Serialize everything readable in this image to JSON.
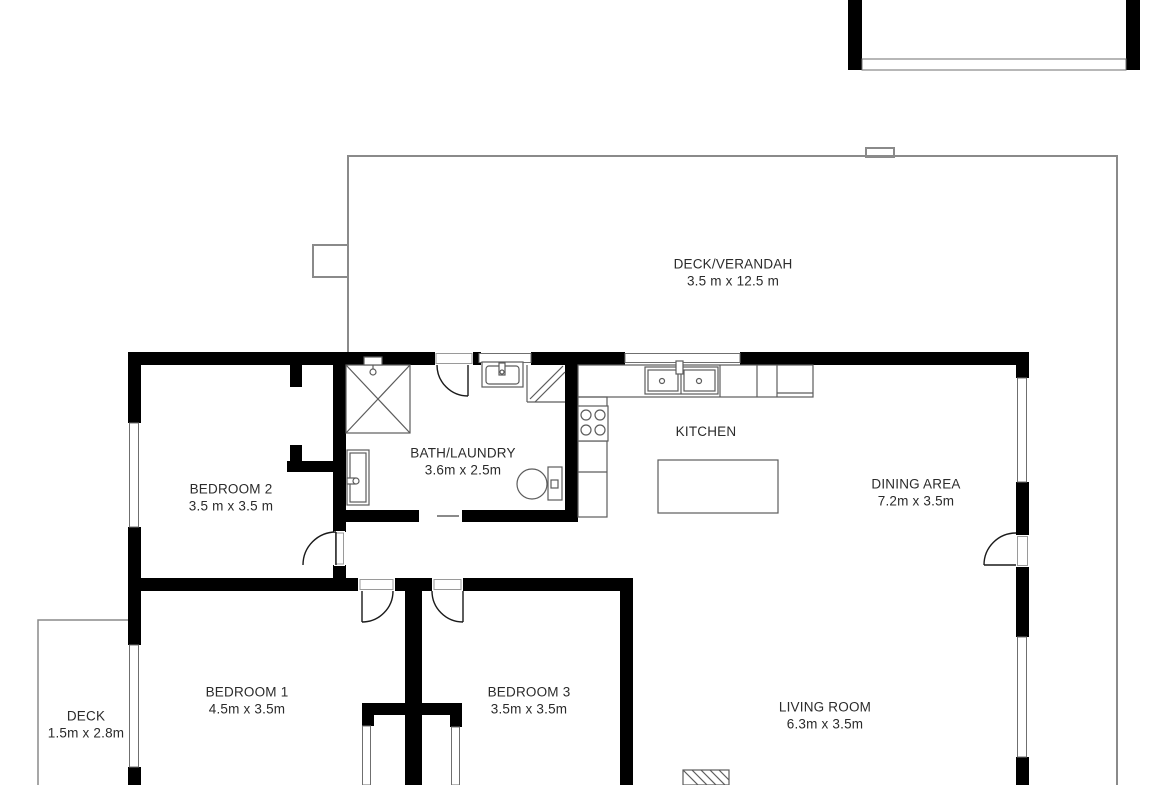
{
  "rooms": {
    "deck_verandah": {
      "name": "DECK/VERANDAH",
      "dims": "3.5 m x 12.5 m"
    },
    "bedroom2": {
      "name": "BEDROOM 2",
      "dims": "3.5 m x 3.5 m"
    },
    "bath_laundry": {
      "name": "BATH/LAUNDRY",
      "dims": "3.6m x 2.5m"
    },
    "kitchen": {
      "name": "KITCHEN"
    },
    "dining": {
      "name": "DINING AREA",
      "dims": "7.2m x 3.5m"
    },
    "bedroom1": {
      "name": "BEDROOM 1",
      "dims": "4.5m x 3.5m"
    },
    "bedroom3": {
      "name": "BEDROOM 3",
      "dims": "3.5m x 3.5m"
    },
    "living": {
      "name": "LIVING ROOM",
      "dims": "6.3m x 3.5m"
    },
    "deck": {
      "name": "DECK",
      "dims": "1.5m x 2.8m"
    }
  },
  "colors": {
    "wall": "#000000",
    "fixture_outline": "#5c5c5c",
    "window_outline": "#6f6f6f",
    "deck_outline": "#8a8a8a",
    "text": "#2b2b2b",
    "background": "#ffffff"
  }
}
